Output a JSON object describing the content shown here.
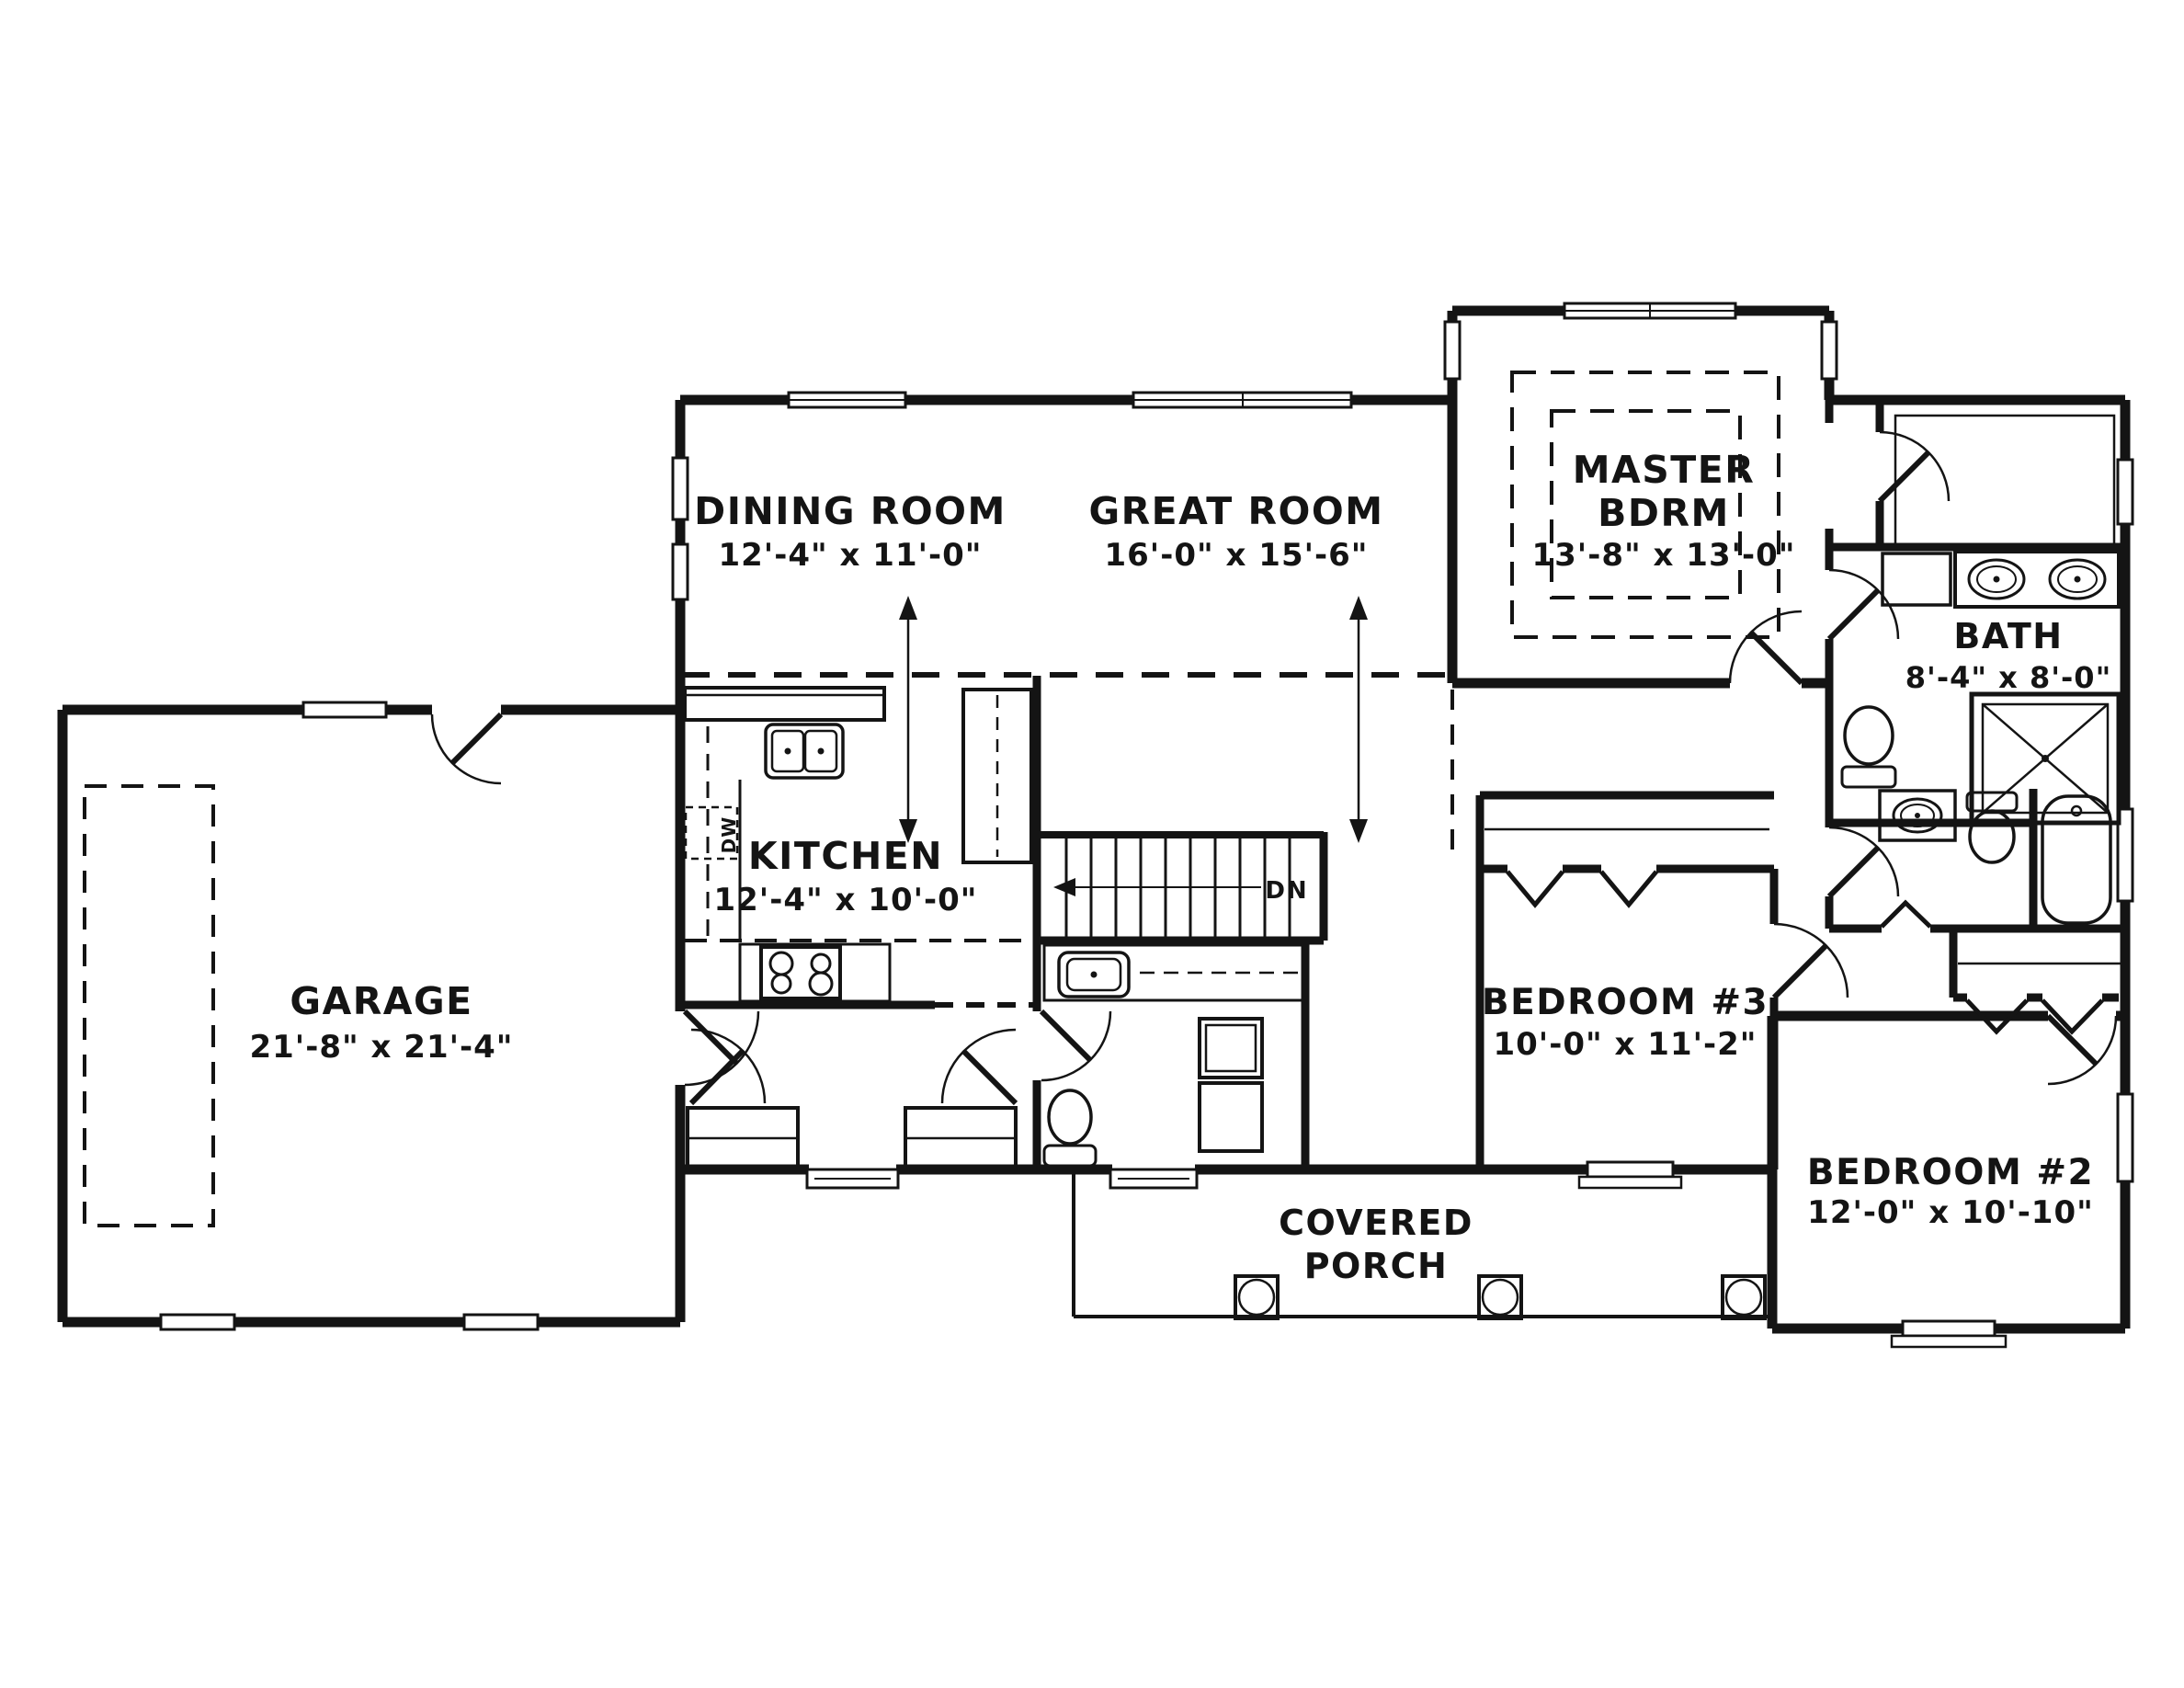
{
  "plan": {
    "type": "single-story house floor plan",
    "rooms": {
      "dining": {
        "name": "DINING ROOM",
        "dims": "12'-4\" x 11'-0\""
      },
      "great": {
        "name": "GREAT ROOM",
        "dims": "16'-0\" x 15'-6\""
      },
      "master": {
        "name_line1": "MASTER",
        "name_line2": "BDRM",
        "dims": "13'-8\" x 13'-0\""
      },
      "bath": {
        "name": "BATH",
        "dims": "8'-4\" x 8'-0\""
      },
      "kitchen": {
        "name": "KITCHEN",
        "dims": "12'-4\" x 10'-0\""
      },
      "garage": {
        "name": "GARAGE",
        "dims": "21'-8\" x 21'-4\""
      },
      "bedroom3": {
        "name": "BEDROOM #3",
        "dims": "10'-0\" x 11'-2\""
      },
      "bedroom2": {
        "name": "BEDROOM #2",
        "dims": "12'-0\" x 10'-10\""
      },
      "porch": {
        "name_line1": "COVERED",
        "name_line2": "PORCH"
      }
    },
    "annotations": {
      "stairs_direction": "DN",
      "dishwasher": "DW"
    },
    "colors": {
      "line": "#141414",
      "background": "#ffffff"
    }
  }
}
